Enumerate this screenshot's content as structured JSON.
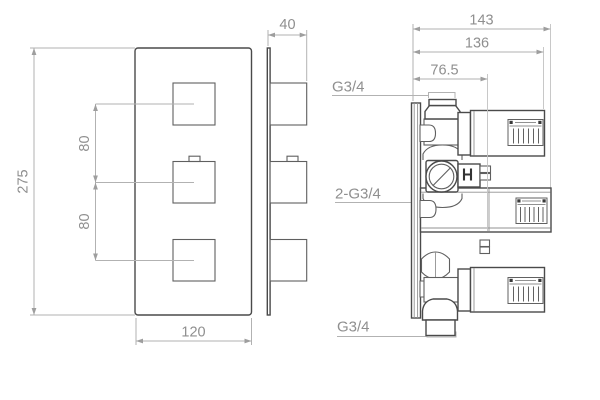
{
  "colors": {
    "background": "#ffffff",
    "object_line": "#4a4a4a",
    "dimension_line": "#b2b2b2",
    "dimension_text": "#8f8f8f"
  },
  "views": {
    "front": {
      "height": "275",
      "width": "120",
      "knob_spacing_upper": "80",
      "knob_spacing_lower": "80"
    },
    "side": {
      "depth": "40"
    },
    "valve": {
      "overall_depth": "143",
      "body_depth": "136",
      "cartridge_depth": "76.5",
      "top_port": "G3/4",
      "inlet_ports": "2-G3/4",
      "bottom_port": "G3/4"
    }
  }
}
